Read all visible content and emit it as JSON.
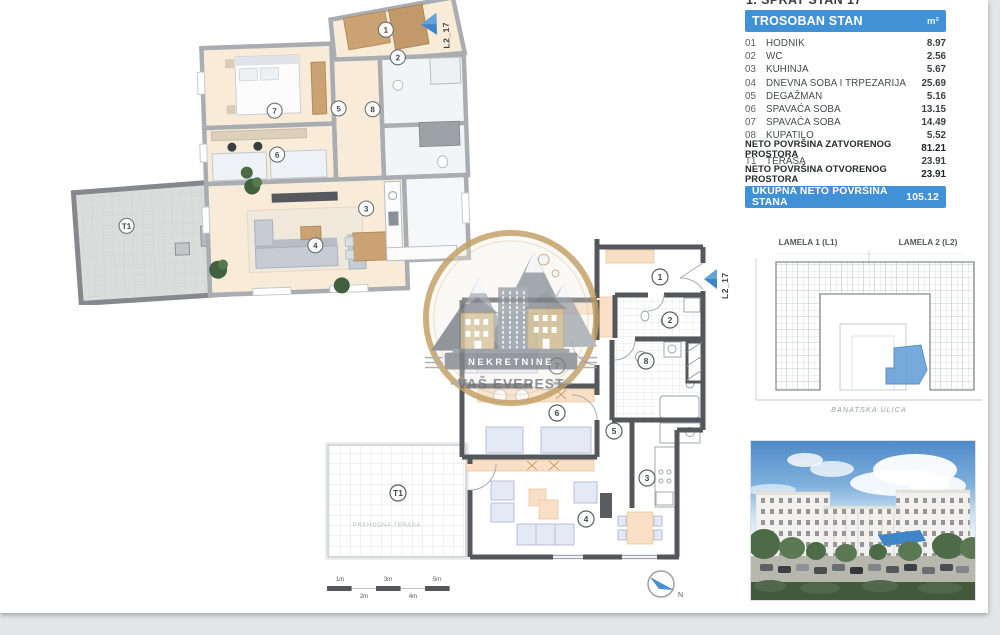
{
  "table": {
    "title": "1. SPRAT STAN 17",
    "header": {
      "label": "TROSOBAN STAN",
      "unit": "m²"
    },
    "rows": [
      {
        "num": "01",
        "name": "HODNIK",
        "value": "8.97"
      },
      {
        "num": "02",
        "name": "WC",
        "value": "2.56"
      },
      {
        "num": "03",
        "name": "KUHINJA",
        "value": "5.67"
      },
      {
        "num": "04",
        "name": "DNEVNA SOBA I TRPEZARIJA",
        "value": "25.69"
      },
      {
        "num": "05",
        "name": "DEGAŽMAN",
        "value": "5.16"
      },
      {
        "num": "06",
        "name": "SPAVAĆA SOBA",
        "value": "13.15"
      },
      {
        "num": "07",
        "name": "SPAVAĆA SOBA",
        "value": "14.49"
      },
      {
        "num": "08",
        "name": "KUPATILO",
        "value": "5.52"
      }
    ],
    "summary": [
      {
        "name": "NETO POVRŠINA ZATVORENOG PROSTORA",
        "value": "81.21"
      },
      {
        "num": "T1",
        "name": "TERASA",
        "value": "23.91"
      },
      {
        "name": "NETO POVRŠINA OTVORENOG PROSTORA",
        "value": "23.91"
      }
    ],
    "total": {
      "label": "UKUPNA NETO POVRŠINA STANA",
      "value": "105.12"
    }
  },
  "floorplan": {
    "unit_label": "L2_17",
    "rooms": [
      "1",
      "2",
      "3",
      "4",
      "5",
      "6",
      "7",
      "8"
    ],
    "terrace_label": "T1",
    "terrace_name": "PREHODNA TERASA",
    "compass_label": "N",
    "scale": {
      "top": [
        "1m",
        "3m",
        "5m"
      ],
      "bottom": [
        "2m",
        "4m"
      ]
    }
  },
  "siteplan": {
    "lamela1": "LAMELA 1  (L1)",
    "lamela2": "LAMELA 2  (L2)",
    "street": "BANATSKA ULICA"
  },
  "logo": {
    "line1": "NEKRETNINE",
    "line2": "VAŠ EVEREST"
  },
  "colors": {
    "accent_blue": "#4191d6",
    "highlight_unit": "#6aa3d8",
    "wall_dark": "#54575b"
  }
}
